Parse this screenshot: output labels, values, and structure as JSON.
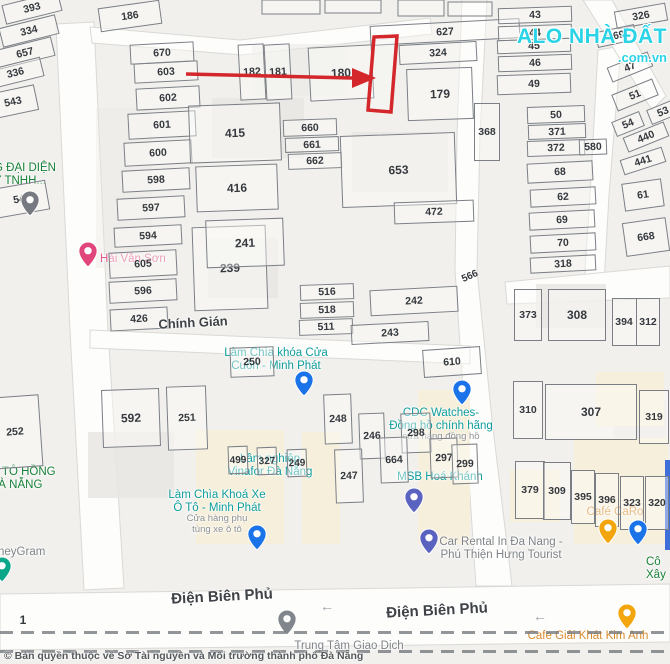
{
  "watermark": {
    "line1": "ALO NHÀ ĐẤT",
    "line2": ".com.vn"
  },
  "copyright": "© Bản quyền thuộc về Sở Tài nguyên và Môi trường thành phố Đà Nẵng",
  "highlight_color": "#d3272b",
  "streets": [
    {
      "name": "Chính Gián",
      "x": 193,
      "y": 315,
      "rot": -3,
      "size": 13
    },
    {
      "name": "Điện Biên Phủ",
      "x": 222,
      "y": 588,
      "rot": -3,
      "size": 15
    },
    {
      "name": "Điện Biên Phủ",
      "x": 437,
      "y": 602,
      "rot": -3,
      "size": 15
    }
  ],
  "road_arrows": [
    {
      "glyph": "←",
      "x": 320,
      "y": 598
    },
    {
      "glyph": "←",
      "x": 533,
      "y": 608
    }
  ],
  "parcels": [
    {
      "n": "393",
      "x": 32,
      "y": 8,
      "w": 58,
      "h": 20,
      "r": -14
    },
    {
      "n": "334",
      "x": 29,
      "y": 31,
      "w": 58,
      "h": 20,
      "r": -14
    },
    {
      "n": "657",
      "x": 25,
      "y": 53,
      "w": 58,
      "h": 20,
      "r": -14
    },
    {
      "n": "336",
      "x": 15,
      "y": 73,
      "w": 55,
      "h": 20,
      "r": -14
    },
    {
      "n": "543",
      "x": 13,
      "y": 102,
      "w": 48,
      "h": 26,
      "r": -12
    },
    {
      "n": "544",
      "x": 22,
      "y": 199,
      "w": 52,
      "h": 30,
      "r": -10
    },
    {
      "n": "252",
      "x": 15,
      "y": 432,
      "w": 52,
      "h": 72,
      "r": -4
    },
    {
      "n": "186",
      "x": 130,
      "y": 16,
      "w": 62,
      "h": 24,
      "r": -8
    },
    {
      "n": "670",
      "x": 162,
      "y": 53,
      "w": 64,
      "h": 20,
      "r": -3
    },
    {
      "n": "603",
      "x": 166,
      "y": 72,
      "w": 64,
      "h": 20,
      "r": -3
    },
    {
      "n": "602",
      "x": 168,
      "y": 98,
      "w": 64,
      "h": 22,
      "r": -3
    },
    {
      "n": "601",
      "x": 162,
      "y": 125,
      "w": 68,
      "h": 26,
      "r": -3
    },
    {
      "n": "600",
      "x": 158,
      "y": 153,
      "w": 68,
      "h": 24,
      "r": -3
    },
    {
      "n": "598",
      "x": 156,
      "y": 180,
      "w": 68,
      "h": 22,
      "r": -3
    },
    {
      "n": "597",
      "x": 151,
      "y": 208,
      "w": 68,
      "h": 22,
      "r": -3
    },
    {
      "n": "594",
      "x": 148,
      "y": 236,
      "w": 68,
      "h": 20,
      "r": -3
    },
    {
      "n": "605",
      "x": 143,
      "y": 264,
      "w": 68,
      "h": 26,
      "r": -3
    },
    {
      "n": "596",
      "x": 143,
      "y": 291,
      "w": 68,
      "h": 22,
      "r": -3
    },
    {
      "n": "426",
      "x": 139,
      "y": 319,
      "w": 58,
      "h": 22,
      "r": -3
    },
    {
      "n": "415",
      "x": 235,
      "y": 133,
      "w": 92,
      "h": 58,
      "r": -2,
      "fs": 12
    },
    {
      "n": "416",
      "x": 237,
      "y": 188,
      "w": 82,
      "h": 46,
      "r": -2,
      "fs": 12
    },
    {
      "n": "239",
      "x": 230,
      "y": 268,
      "w": 74,
      "h": 84,
      "r": -2,
      "fs": 12
    },
    {
      "n": "182",
      "x": 252,
      "y": 72,
      "w": 26,
      "h": 56,
      "r": -3
    },
    {
      "n": "181",
      "x": 278,
      "y": 72,
      "w": 26,
      "h": 56,
      "r": -3
    },
    {
      "n": "180",
      "x": 341,
      "y": 73,
      "w": 64,
      "h": 54,
      "r": -3,
      "fs": 12
    },
    {
      "n": "627",
      "x": 445,
      "y": 32,
      "w": 150,
      "h": 20,
      "r": -3
    },
    {
      "n": "324",
      "x": 438,
      "y": 53,
      "w": 78,
      "h": 20,
      "r": -3
    },
    {
      "n": "179",
      "x": 440,
      "y": 94,
      "w": 66,
      "h": 52,
      "r": -2,
      "fs": 12
    },
    {
      "n": "660",
      "x": 310,
      "y": 127,
      "w": 54,
      "h": 17,
      "r": -2
    },
    {
      "n": "661",
      "x": 312,
      "y": 144,
      "w": 54,
      "h": 15,
      "r": -2
    },
    {
      "n": "662",
      "x": 315,
      "y": 161,
      "w": 54,
      "h": 16,
      "r": -2
    },
    {
      "n": "653",
      "x": 398,
      "y": 170,
      "w": 115,
      "h": 72,
      "r": -2,
      "fs": 12
    },
    {
      "n": "472",
      "x": 434,
      "y": 212,
      "w": 80,
      "h": 22,
      "r": -2
    },
    {
      "n": "241",
      "x": 245,
      "y": 243,
      "w": 78,
      "h": 48,
      "r": -2,
      "fs": 12
    },
    {
      "n": "516",
      "x": 327,
      "y": 292,
      "w": 54,
      "h": 16,
      "r": -2
    },
    {
      "n": "518",
      "x": 327,
      "y": 310,
      "w": 54,
      "h": 16,
      "r": -2
    },
    {
      "n": "511",
      "x": 326,
      "y": 327,
      "w": 54,
      "h": 16,
      "r": -2
    },
    {
      "n": "242",
      "x": 414,
      "y": 301,
      "w": 88,
      "h": 26,
      "r": -3
    },
    {
      "n": "243",
      "x": 390,
      "y": 333,
      "w": 78,
      "h": 20,
      "r": -3
    },
    {
      "n": "566",
      "x": 470,
      "y": 276,
      "w": 24,
      "h": 13,
      "r": -24,
      "lo": true,
      "fs": 10
    },
    {
      "n": "610",
      "x": 452,
      "y": 362,
      "w": 58,
      "h": 28,
      "r": -4
    },
    {
      "n": "43",
      "x": 535,
      "y": 15,
      "w": 74,
      "h": 16,
      "r": -2
    },
    {
      "n": "44",
      "x": 535,
      "y": 32,
      "w": 74,
      "h": 15,
      "r": -2
    },
    {
      "n": "45",
      "x": 534,
      "y": 46,
      "w": 74,
      "h": 14,
      "r": -2
    },
    {
      "n": "46",
      "x": 535,
      "y": 63,
      "w": 74,
      "h": 16,
      "r": -2
    },
    {
      "n": "49",
      "x": 534,
      "y": 84,
      "w": 74,
      "h": 20,
      "r": -2
    },
    {
      "n": "50",
      "x": 556,
      "y": 114,
      "w": 58,
      "h": 17,
      "r": -2
    },
    {
      "n": "371",
      "x": 557,
      "y": 131,
      "w": 58,
      "h": 15,
      "r": -2
    },
    {
      "n": "372",
      "x": 556,
      "y": 148,
      "w": 58,
      "h": 16,
      "r": -2
    },
    {
      "n": "368",
      "x": 487,
      "y": 132,
      "w": 26,
      "h": 58,
      "r": 0
    },
    {
      "n": "580",
      "x": 593,
      "y": 147,
      "w": 28,
      "h": 16,
      "r": -2
    },
    {
      "n": "68",
      "x": 560,
      "y": 172,
      "w": 66,
      "h": 20,
      "r": -3
    },
    {
      "n": "62",
      "x": 563,
      "y": 197,
      "w": 66,
      "h": 18,
      "r": -3
    },
    {
      "n": "69",
      "x": 562,
      "y": 220,
      "w": 66,
      "h": 18,
      "r": -3
    },
    {
      "n": "70",
      "x": 563,
      "y": 243,
      "w": 66,
      "h": 18,
      "r": -3
    },
    {
      "n": "318",
      "x": 563,
      "y": 264,
      "w": 66,
      "h": 16,
      "r": -3
    },
    {
      "n": "373",
      "x": 528,
      "y": 315,
      "w": 28,
      "h": 52,
      "r": 0
    },
    {
      "n": "308",
      "x": 577,
      "y": 315,
      "w": 58,
      "h": 52,
      "r": 0,
      "fs": 12
    },
    {
      "n": "394",
      "x": 624,
      "y": 322,
      "w": 25,
      "h": 48,
      "r": 0
    },
    {
      "n": "312",
      "x": 648,
      "y": 322,
      "w": 24,
      "h": 48,
      "r": 0
    },
    {
      "n": "326",
      "x": 641,
      "y": 16,
      "w": 52,
      "h": 18,
      "r": -10
    },
    {
      "n": "569",
      "x": 616,
      "y": 36,
      "w": 40,
      "h": 16,
      "r": -12
    },
    {
      "n": "47",
      "x": 630,
      "y": 67,
      "w": 44,
      "h": 16,
      "r": -22
    },
    {
      "n": "51",
      "x": 635,
      "y": 95,
      "w": 44,
      "h": 18,
      "r": -22
    },
    {
      "n": "53",
      "x": 663,
      "y": 112,
      "w": 30,
      "h": 16,
      "r": -22
    },
    {
      "n": "54",
      "x": 628,
      "y": 124,
      "w": 30,
      "h": 16,
      "r": -22
    },
    {
      "n": "440",
      "x": 646,
      "y": 137,
      "w": 44,
      "h": 16,
      "r": -22
    },
    {
      "n": "441",
      "x": 643,
      "y": 161,
      "w": 44,
      "h": 16,
      "r": -18
    },
    {
      "n": "61",
      "x": 643,
      "y": 195,
      "w": 40,
      "h": 28,
      "r": -8
    },
    {
      "n": "668",
      "x": 646,
      "y": 237,
      "w": 44,
      "h": 34,
      "r": -8
    },
    {
      "n": "310",
      "x": 528,
      "y": 410,
      "w": 30,
      "h": 58,
      "r": 0
    },
    {
      "n": "307",
      "x": 591,
      "y": 412,
      "w": 92,
      "h": 56,
      "r": 0,
      "fs": 12
    },
    {
      "n": "319",
      "x": 654,
      "y": 417,
      "w": 30,
      "h": 54,
      "r": 0
    },
    {
      "n": "379",
      "x": 530,
      "y": 490,
      "w": 30,
      "h": 58,
      "r": 0
    },
    {
      "n": "309",
      "x": 557,
      "y": 491,
      "w": 28,
      "h": 58,
      "r": 0
    },
    {
      "n": "395",
      "x": 583,
      "y": 497,
      "w": 24,
      "h": 54,
      "r": 0
    },
    {
      "n": "396",
      "x": 607,
      "y": 500,
      "w": 24,
      "h": 54,
      "r": 0
    },
    {
      "n": "323",
      "x": 632,
      "y": 503,
      "w": 24,
      "h": 54,
      "r": 0
    },
    {
      "n": "320",
      "x": 657,
      "y": 503,
      "w": 24,
      "h": 54,
      "r": 0
    },
    {
      "n": "592",
      "x": 131,
      "y": 418,
      "w": 58,
      "h": 58,
      "r": -2,
      "fs": 12
    },
    {
      "n": "251",
      "x": 187,
      "y": 418,
      "w": 40,
      "h": 64,
      "r": -2
    },
    {
      "n": "250",
      "x": 252,
      "y": 362,
      "w": 44,
      "h": 30,
      "r": -2
    },
    {
      "n": "248",
      "x": 338,
      "y": 419,
      "w": 28,
      "h": 50,
      "r": -2
    },
    {
      "n": "246",
      "x": 372,
      "y": 436,
      "w": 26,
      "h": 46,
      "r": -2
    },
    {
      "n": "298",
      "x": 416,
      "y": 433,
      "w": 30,
      "h": 40,
      "r": -2
    },
    {
      "n": "664",
      "x": 394,
      "y": 460,
      "w": 28,
      "h": 46,
      "r": -2
    },
    {
      "n": "297",
      "x": 444,
      "y": 458,
      "w": 28,
      "h": 40,
      "r": -2
    },
    {
      "n": "299",
      "x": 465,
      "y": 464,
      "w": 26,
      "h": 40,
      "r": -2
    },
    {
      "n": "247",
      "x": 349,
      "y": 476,
      "w": 28,
      "h": 54,
      "r": -2
    },
    {
      "n": "499",
      "x": 238,
      "y": 460,
      "w": 20,
      "h": 28,
      "r": -2,
      "fs": 10
    },
    {
      "n": "327",
      "x": 267,
      "y": 461,
      "w": 20,
      "h": 28,
      "r": -2,
      "fs": 10
    },
    {
      "n": "249",
      "x": 297,
      "y": 463,
      "w": 20,
      "h": 28,
      "r": -2,
      "fs": 10
    },
    {
      "n": "1",
      "x": 23,
      "y": 620,
      "w": 14,
      "h": 14,
      "r": 0,
      "lo": true,
      "fs": 12
    }
  ],
  "pois": [
    {
      "id": "office-rep",
      "color": "green",
      "align": "left",
      "x": -6,
      "y": 162,
      "lines": [
        "G ĐẠI DIỆN",
        "Y TNHH..."
      ]
    },
    {
      "id": "place-544",
      "lines": [],
      "pin": {
        "name": "place-544-pin-icon",
        "color": "#777b81",
        "x": 20,
        "y": 190
      }
    },
    {
      "id": "hai-van-son",
      "color": "pink",
      "align": "left",
      "x": 100,
      "y": 253,
      "lines": [
        "Hải Vân Sơn"
      ],
      "pin": {
        "name": "hai-van-son-pin-icon",
        "color": "#e0467c",
        "x": 78,
        "y": 241
      }
    },
    {
      "id": "lam-chia-khoa-cua",
      "color": "teal",
      "x": 276,
      "y": 347,
      "lines": [
        "Làm Chìa khóa Cửa",
        "Cuốn - Minh Phát"
      ],
      "pin": {
        "name": "key-shop-pin-icon",
        "color": "#1a73e8",
        "x": 294,
        "y": 370
      }
    },
    {
      "id": "cdc-watches",
      "color": "teal",
      "x": 441,
      "y": 407,
      "lines": [
        "CDC Watches-",
        "Đồng hồ chính hãng"
      ],
      "sub": [
        "cửa hàng đồng hồ"
      ],
      "pin": {
        "name": "watch-shop-pin-icon",
        "color": "#1a73e8",
        "x": 452,
        "y": 379
      }
    },
    {
      "id": "vinafor",
      "color": "teal",
      "x": 270,
      "y": 453,
      "lines": [
        "Lâm nghiệp",
        "Vinafor Đà Nẵng"
      ]
    },
    {
      "id": "lam-chia-khoa-xe",
      "color": "teal",
      "x": 217,
      "y": 489,
      "lines": [
        "Làm Chìa Khoá Xe",
        "Ô Tô - Minh Phát"
      ],
      "sub": [
        "Cửa hàng phụ",
        "tùng xe ô tô"
      ],
      "pin": {
        "name": "car-key-shop-pin-icon",
        "color": "#1a73e8",
        "x": 247,
        "y": 524
      }
    },
    {
      "id": "msb-hoa-khanh",
      "color": "teal",
      "x": 440,
      "y": 471,
      "lines": [
        "MSB Hoá Khánh"
      ],
      "pin": {
        "name": "bank-pin-icon",
        "color": "#5b63c1",
        "x": 404,
        "y": 487
      }
    },
    {
      "id": "car-rental",
      "color": "gray",
      "x": 501,
      "y": 536,
      "lines": [
        "Car Rental In Đa Nang -",
        "Phú Thiện Hưng Tourist"
      ],
      "pin": {
        "name": "car-rental-pin-icon",
        "color": "#5b63c1",
        "x": 419,
        "y": 528
      }
    },
    {
      "id": "cafe-caro",
      "color": "orange",
      "x": 615,
      "y": 506,
      "lines": [
        "Café CaRo"
      ],
      "pin": {
        "name": "cafe-caro-pin-icon",
        "color": "#f2a50c",
        "x": 598,
        "y": 518
      },
      "pin2": {
        "name": "shopping-pin-icon",
        "color": "#1a73e8",
        "x": 628,
        "y": 519
      }
    },
    {
      "id": "cafe-kim-anh",
      "color": "orange",
      "x": 588,
      "y": 630,
      "lines": [
        "Cafe Giải Khát Kim Anh"
      ],
      "pin": {
        "name": "cafe-kim-anh-pin-icon",
        "color": "#f2a50c",
        "x": 617,
        "y": 603
      }
    },
    {
      "id": "xay-lap",
      "color": "green",
      "align": "left",
      "x": 646,
      "y": 556,
      "lines": [
        "Cô",
        "Xây Lắ"
      ]
    },
    {
      "id": "oto-hong",
      "color": "green",
      "align": "left",
      "x": -10,
      "y": 466,
      "lines": [
        "Ô TÔ HỒNG",
        "ĐÀ NẴNG"
      ]
    },
    {
      "id": "moneygram",
      "color": "gray",
      "align": "left",
      "x": -2,
      "y": 546,
      "lines": [
        "neyGram"
      ],
      "pin": {
        "name": "moneygram-pin-icon",
        "color": "#0ca789",
        "x": -8,
        "y": 556
      }
    },
    {
      "id": "trung-tam-giao-dich",
      "color": "gray",
      "x": 349,
      "y": 640,
      "lines": [
        "Trung Tâm Giao Dịch"
      ],
      "pin": {
        "name": "trung-tam-pin-icon",
        "color": "#80868b",
        "x": 277,
        "y": 609
      }
    }
  ]
}
